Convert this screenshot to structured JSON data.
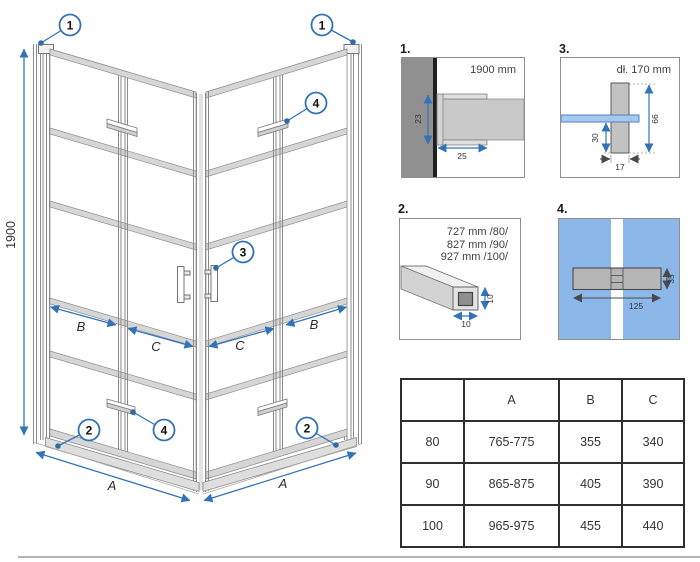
{
  "colors": {
    "accent_blue": "#3273b8",
    "glass_blue": "#8cb7e9",
    "wall_gray": "#909090",
    "band_gray": "#d6d6d6"
  },
  "main": {
    "height_label": "1900",
    "dim_a": "A",
    "dim_b": "B",
    "dim_c": "C",
    "callouts": {
      "n1": "1",
      "n2": "2",
      "n3": "3",
      "n4": "4"
    }
  },
  "details": {
    "d1": {
      "label": "1.",
      "note": "1900 mm",
      "dim_depth": "23",
      "dim_width": "25"
    },
    "d2": {
      "label": "2.",
      "line1": "727 mm /80/",
      "line2": "827 mm /90/",
      "line3": "927 mm /100/",
      "dim_w": "10",
      "dim_h": "10"
    },
    "d3": {
      "label": "3.",
      "note": "dł. 170 mm",
      "dim_height": "66",
      "dim_offset": "30",
      "dim_width": "17"
    },
    "d4": {
      "label": "4.",
      "dim_length": "125",
      "dim_height": "35"
    }
  },
  "table": {
    "headers": [
      "",
      "A",
      "B",
      "C"
    ],
    "rows": [
      [
        "80",
        "765-775",
        "355",
        "340"
      ],
      [
        "90",
        "865-875",
        "405",
        "390"
      ],
      [
        "100",
        "965-975",
        "455",
        "440"
      ]
    ]
  }
}
